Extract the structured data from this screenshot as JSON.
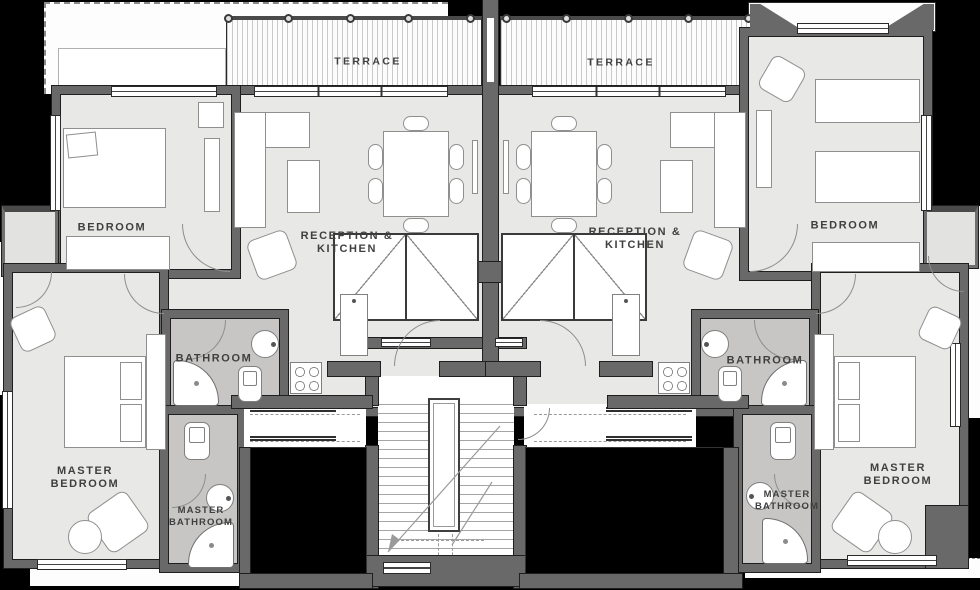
{
  "title": "Two-unit apartment floor plan",
  "colors": {
    "background": "#000000",
    "wall": "#696969",
    "floor": "#e8e8e7",
    "bathroom_floor": "#c7c6c5",
    "terrace": "#fcfcfc",
    "corridor_white": "#ffffff",
    "label_text": "#3f3f3f",
    "furniture_outline": "#8f8f8f"
  },
  "units": [
    {
      "side": "left",
      "terrace": "TERRACE",
      "bedroom": "BEDROOM",
      "reception": "RECEPTION &\nKITCHEN",
      "bathroom": "BATHROOM",
      "master_bedroom": "MASTER\nBEDROOM",
      "master_bathroom": "MASTER\nBATHROOM"
    },
    {
      "side": "right",
      "terrace": "TERRACE",
      "bedroom": "BEDROOM",
      "reception": "RECEPTION &\nKITCHEN",
      "bathroom": "BATHROOM",
      "master_bedroom": "MASTER\nBEDROOM",
      "master_bathroom": "MASTER\nBATHROOM"
    }
  ]
}
